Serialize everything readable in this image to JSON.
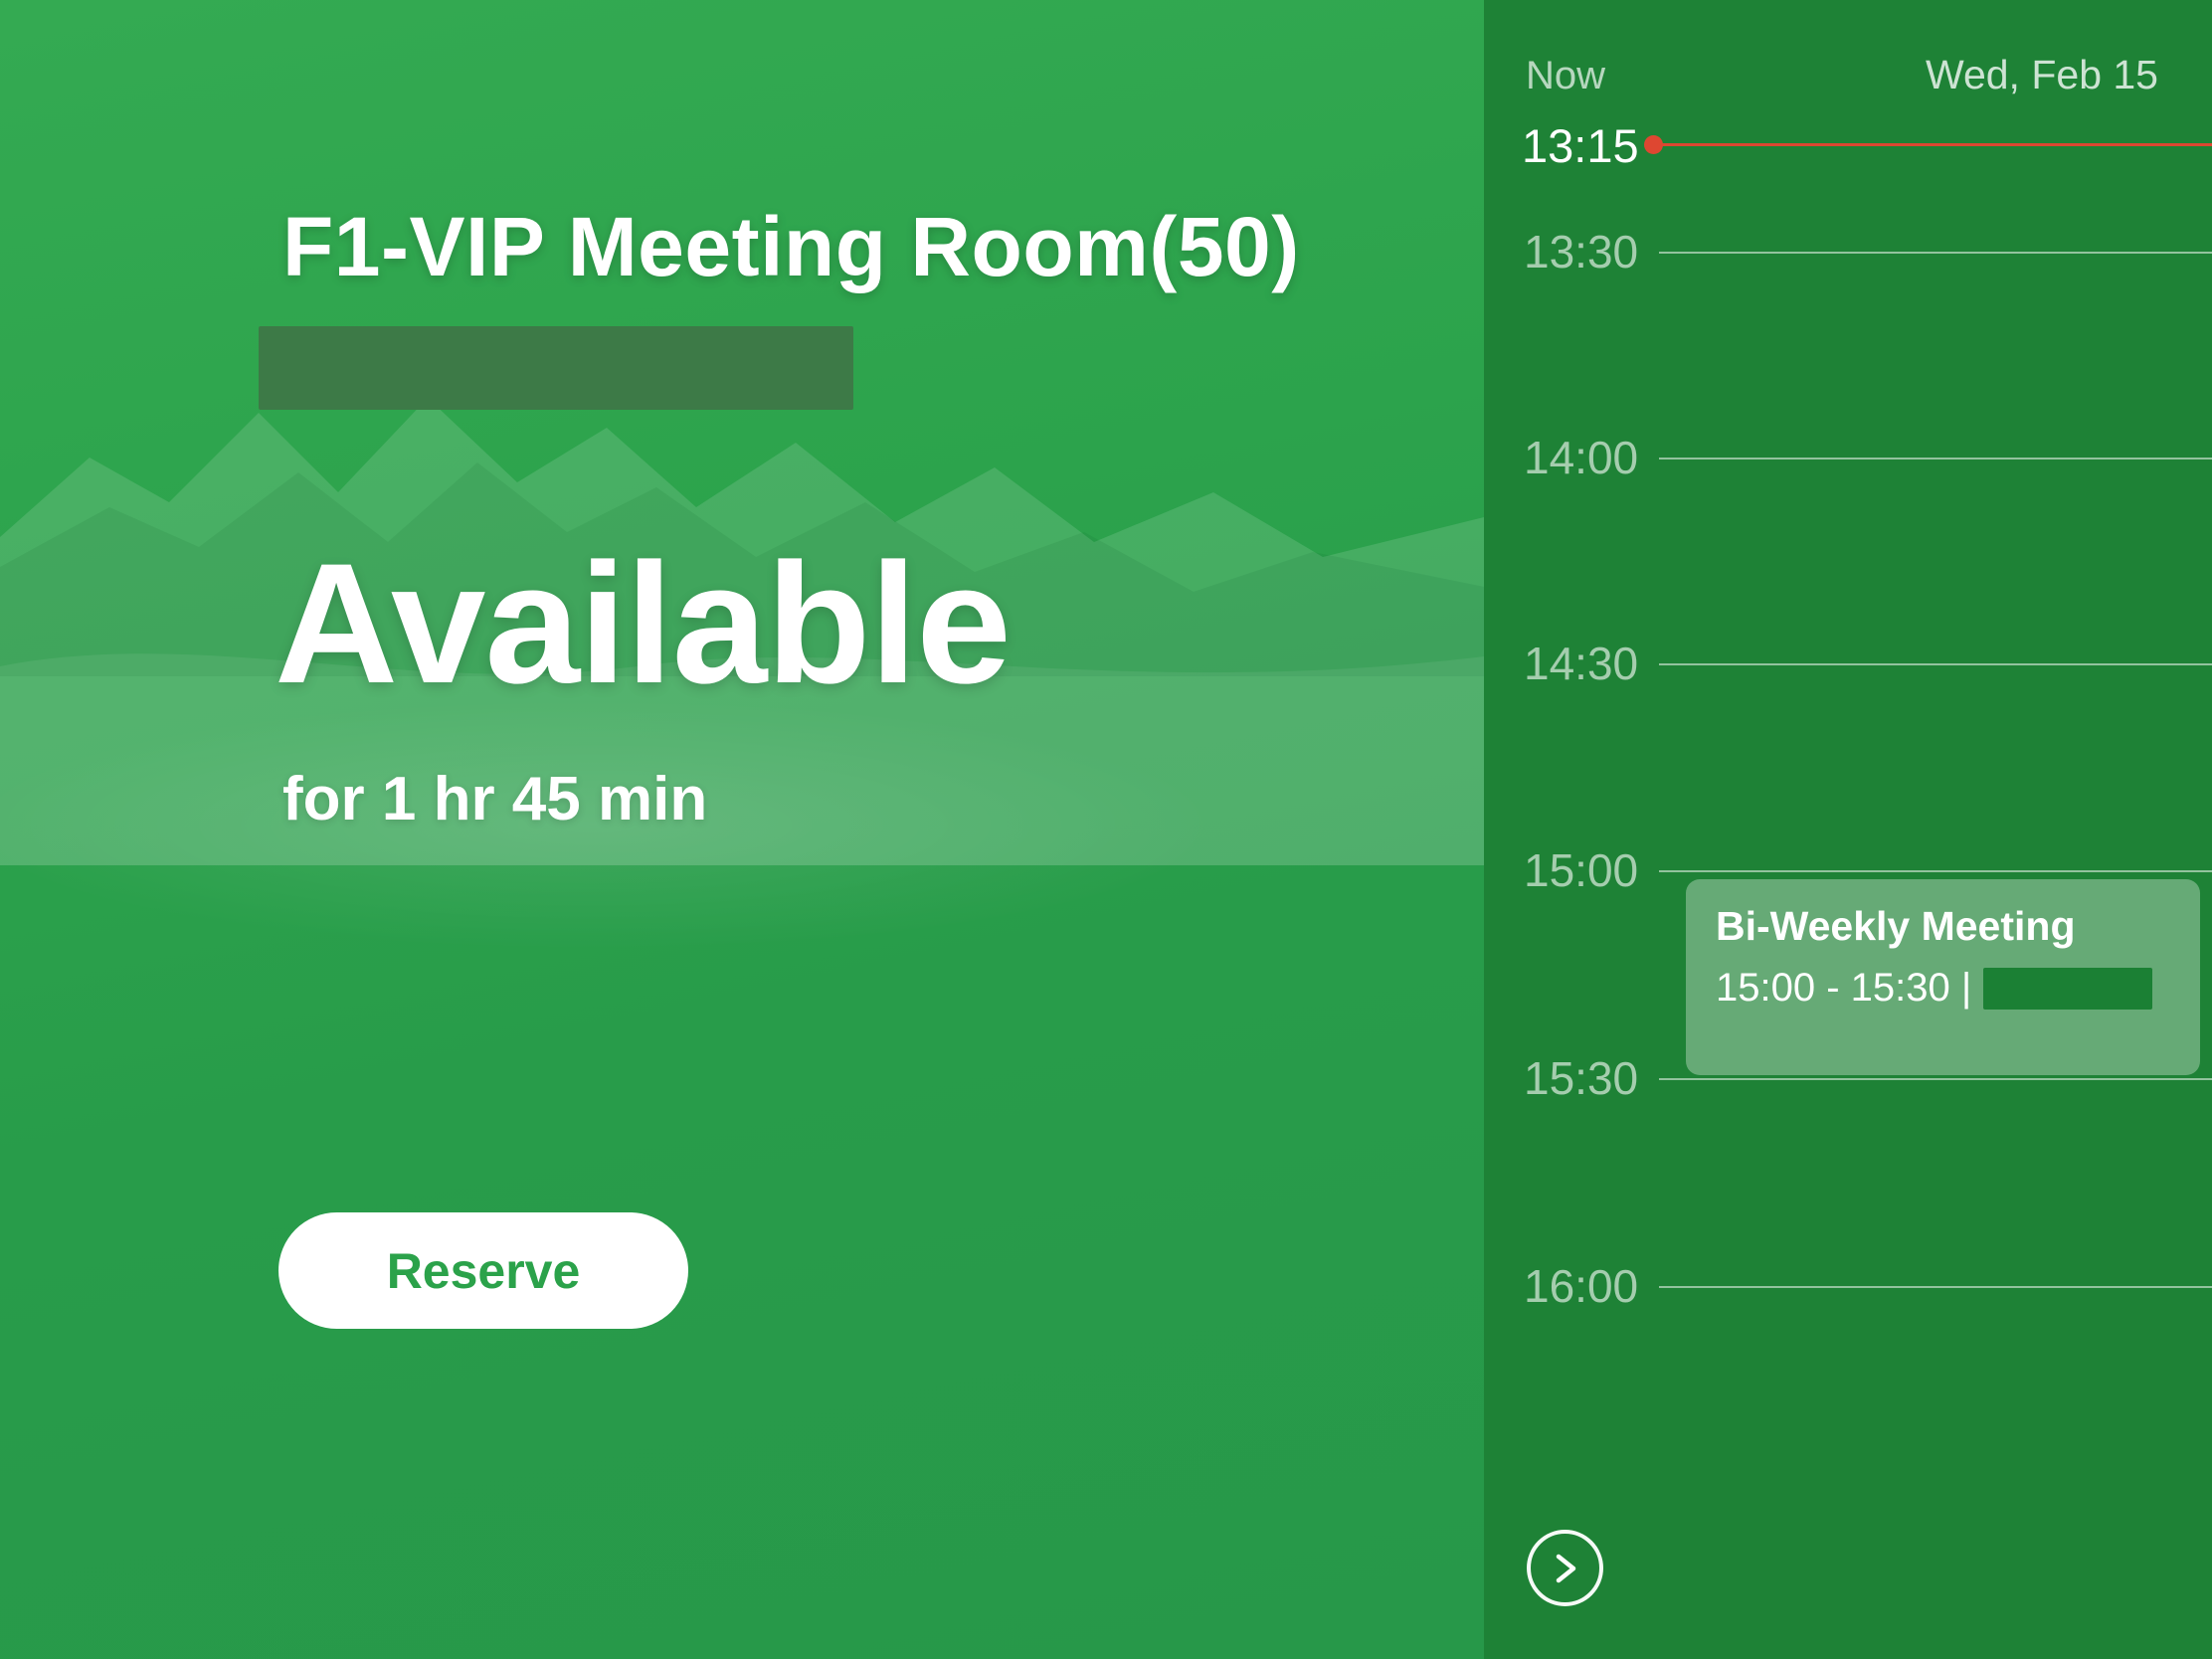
{
  "room_panel": {
    "title": "F1-VIP Meeting Room(50)",
    "status": "Available",
    "duration": "for 1 hr 45 min",
    "reserve_button_label": "Reserve"
  },
  "schedule_panel": {
    "now_label": "Now",
    "date_label": "Wed, Feb 15",
    "current_time": "13:15",
    "time_slots": [
      "13:30",
      "14:00",
      "14:30",
      "15:00",
      "15:30",
      "16:00"
    ],
    "event": {
      "title": "Bi-Weekly Meeting",
      "time_text": "15:00 - 15:30 |"
    },
    "next_icon": "chevron-right-icon"
  },
  "colors": {
    "main_green_top": "#34aa52",
    "main_green_bottom": "#279849",
    "sidebar_green": "#1e8236",
    "now_red": "#de4731",
    "reserve_text_green": "#2ba24a",
    "event_card_bg": "rgba(255,255,255,0.32)",
    "redaction_main": "#3d7a47",
    "redaction_event": "#1b8034",
    "grid_line": "rgba(255,255,255,0.52)"
  }
}
